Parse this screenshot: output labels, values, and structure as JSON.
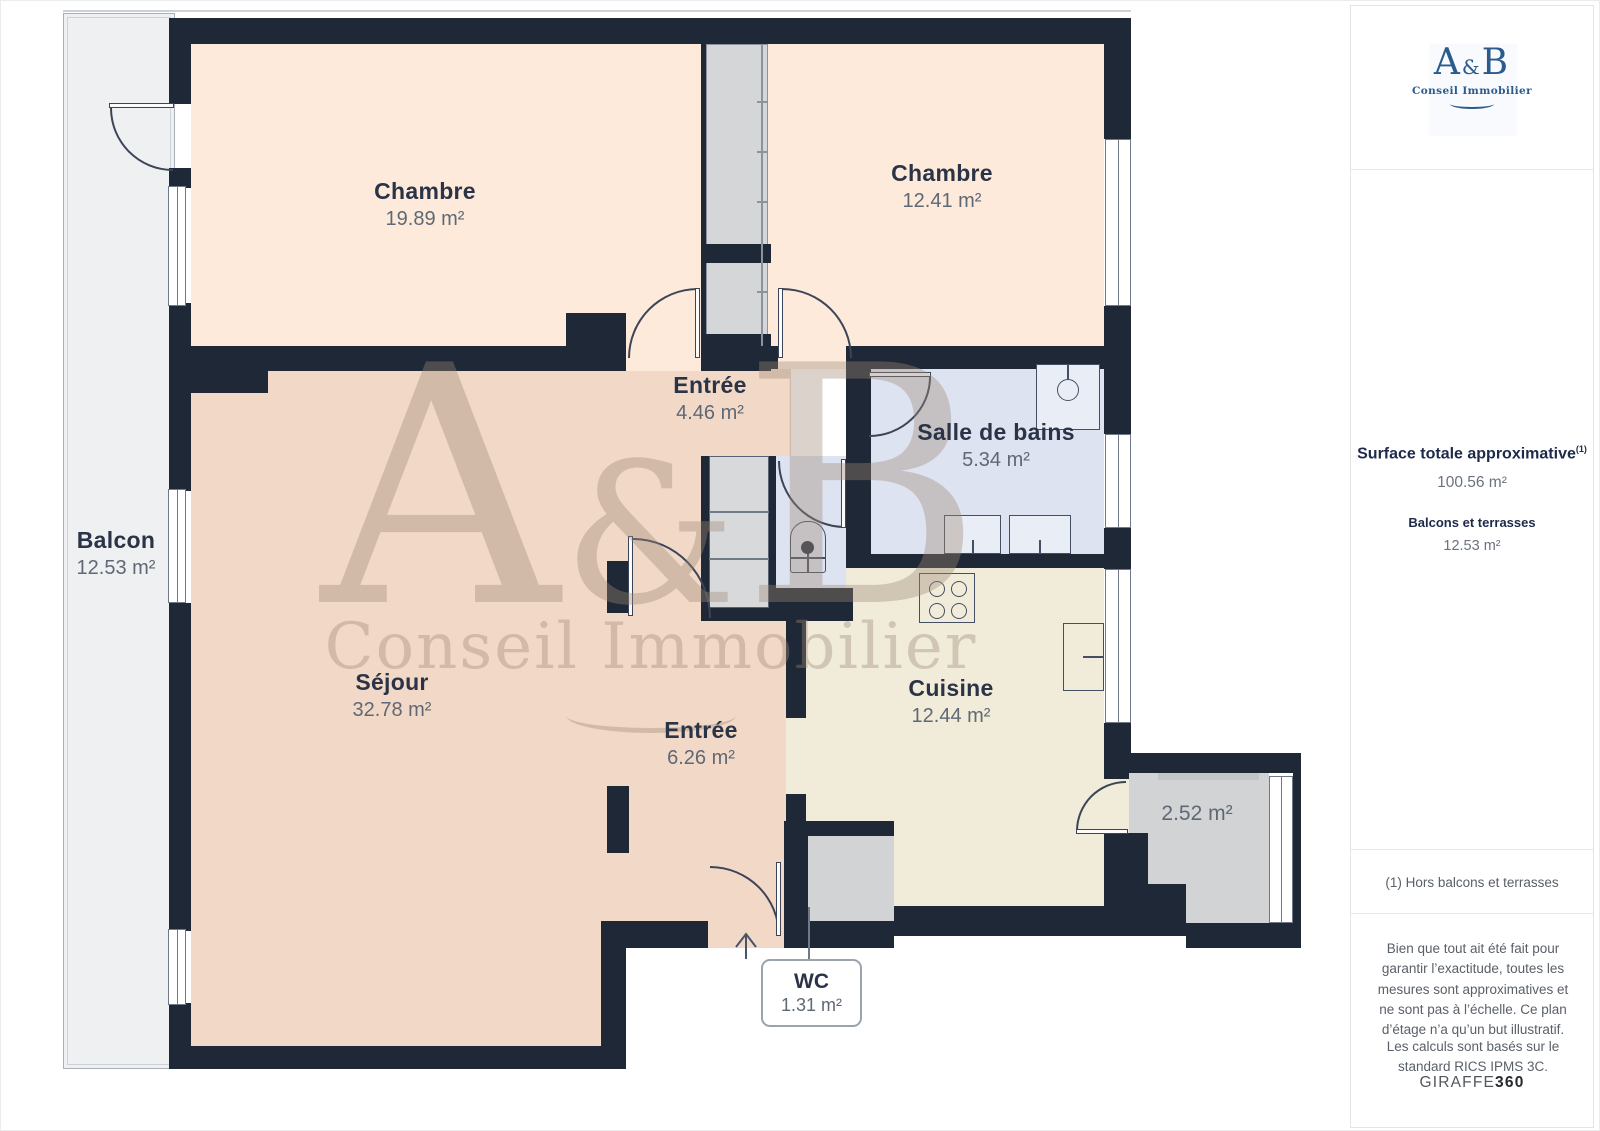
{
  "floorplan": {
    "watermark": {
      "brand_a": "A",
      "brand_amp": "&",
      "brand_b": "B",
      "tagline": "Conseil Immobilier"
    },
    "rooms": {
      "chambre_left": {
        "label": "Chambre",
        "area": "19.89 m²"
      },
      "chambre_right": {
        "label": "Chambre",
        "area": "12.41 m²"
      },
      "entree_haut": {
        "label": "Entrée",
        "area": "4.46 m²"
      },
      "salle_de_bains": {
        "label": "Salle de bains",
        "area": "5.34 m²"
      },
      "balcon": {
        "label": "Balcon",
        "area": "12.53 m²"
      },
      "sejour": {
        "label": "Séjour",
        "area": "32.78 m²"
      },
      "entree_bas": {
        "label": "Entrée",
        "area": "6.26 m²"
      },
      "cuisine": {
        "label": "Cuisine",
        "area": "12.44 m²"
      },
      "rangement": {
        "area": "2.52 m²"
      },
      "wc": {
        "label": "WC",
        "area": "1.31 m²"
      }
    }
  },
  "sidebar": {
    "logo": {
      "brand_a": "A",
      "brand_amp": "&",
      "brand_b": "B",
      "tagline": "Conseil Immobilier"
    },
    "surface": {
      "title": "Surface totale approximative",
      "title_superscript": "(1)",
      "value": "100.56 m²",
      "balcony_label": "Balcons et terrasses",
      "balcony_value": "12.53 m²"
    },
    "footnote": "(1) Hors balcons et terrasses",
    "disclaimer": "Bien que tout ait été fait pour garantir l’exactitude, toutes les mesures sont approximatives et ne sont pas à l’échelle. Ce plan d’étage n’a qu’un but illustratif.",
    "standard": "Les calculs sont basés sur le standard RICS IPMS 3C.",
    "brand_footer": {
      "name": "GIRAFFE",
      "suffix": "360"
    }
  },
  "colors": {
    "wall": "#1f2836",
    "chambre": "#fdeada",
    "sejour": "#f2d9c7",
    "cuisine": "#f1ecd9",
    "salle_de_bains": "#dde3f0",
    "balcon": "#eff0f1",
    "rangement": "#d2d3d4",
    "brand_blue": "#2b5a8c"
  }
}
